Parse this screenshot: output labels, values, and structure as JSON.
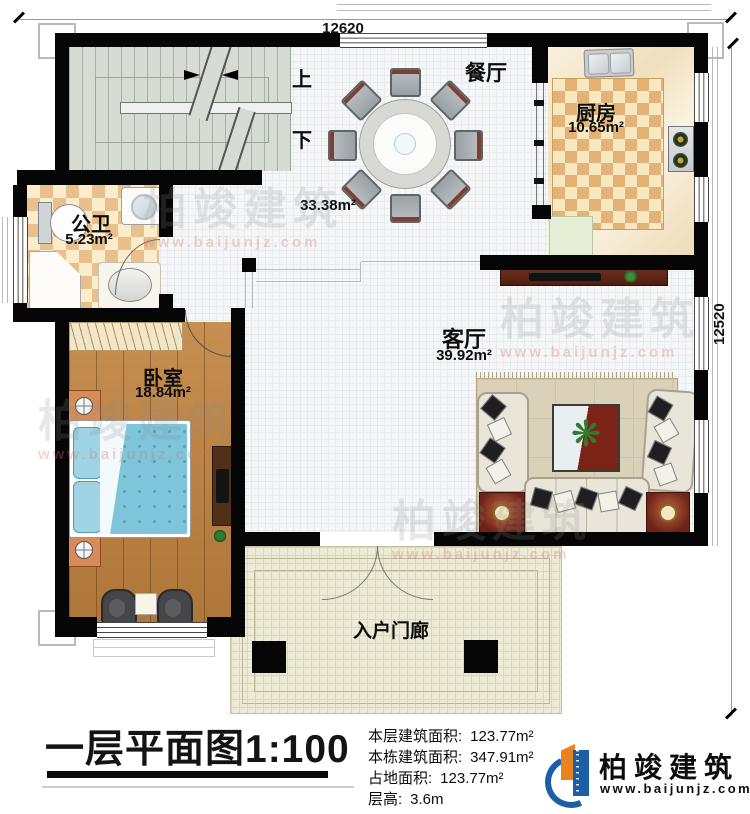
{
  "plan": {
    "dims": {
      "top": "12620",
      "right": "12520"
    },
    "rooms": {
      "dining": {
        "name": "餐厅",
        "area": "33.38m²"
      },
      "kitchen": {
        "name": "厨房",
        "area": "10.65m²"
      },
      "bath": {
        "name": "公卫",
        "area": "5.23m²"
      },
      "bedroom": {
        "name": "卧室",
        "area": "18.84m²"
      },
      "living": {
        "name": "客厅",
        "area": "39.92m²"
      },
      "porch": {
        "name": "入户门廊"
      }
    },
    "stairs": {
      "up": "上",
      "down": "下"
    },
    "footer": {
      "title": "一层平面图1:100",
      "stats": [
        {
          "label": "本层建筑面积:",
          "value": "123.77m²"
        },
        {
          "label": "本栋建筑面积:",
          "value": "347.91m²"
        },
        {
          "label": "占地面积:",
          "value": "123.77m²"
        },
        {
          "label": "层高:",
          "value": "3.6m"
        }
      ],
      "brand": {
        "name": "柏竣建筑",
        "url": "www.baijunjz.com"
      }
    },
    "watermark": {
      "text": "柏竣建筑",
      "url": "www.baijunjz.com"
    },
    "colors": {
      "wall": "#060606",
      "brand_blue": "#1d5fa6",
      "brand_orange": "#e8831d",
      "bed": "#7ec5da"
    }
  },
  "icons": {
    "plant": "❋"
  }
}
